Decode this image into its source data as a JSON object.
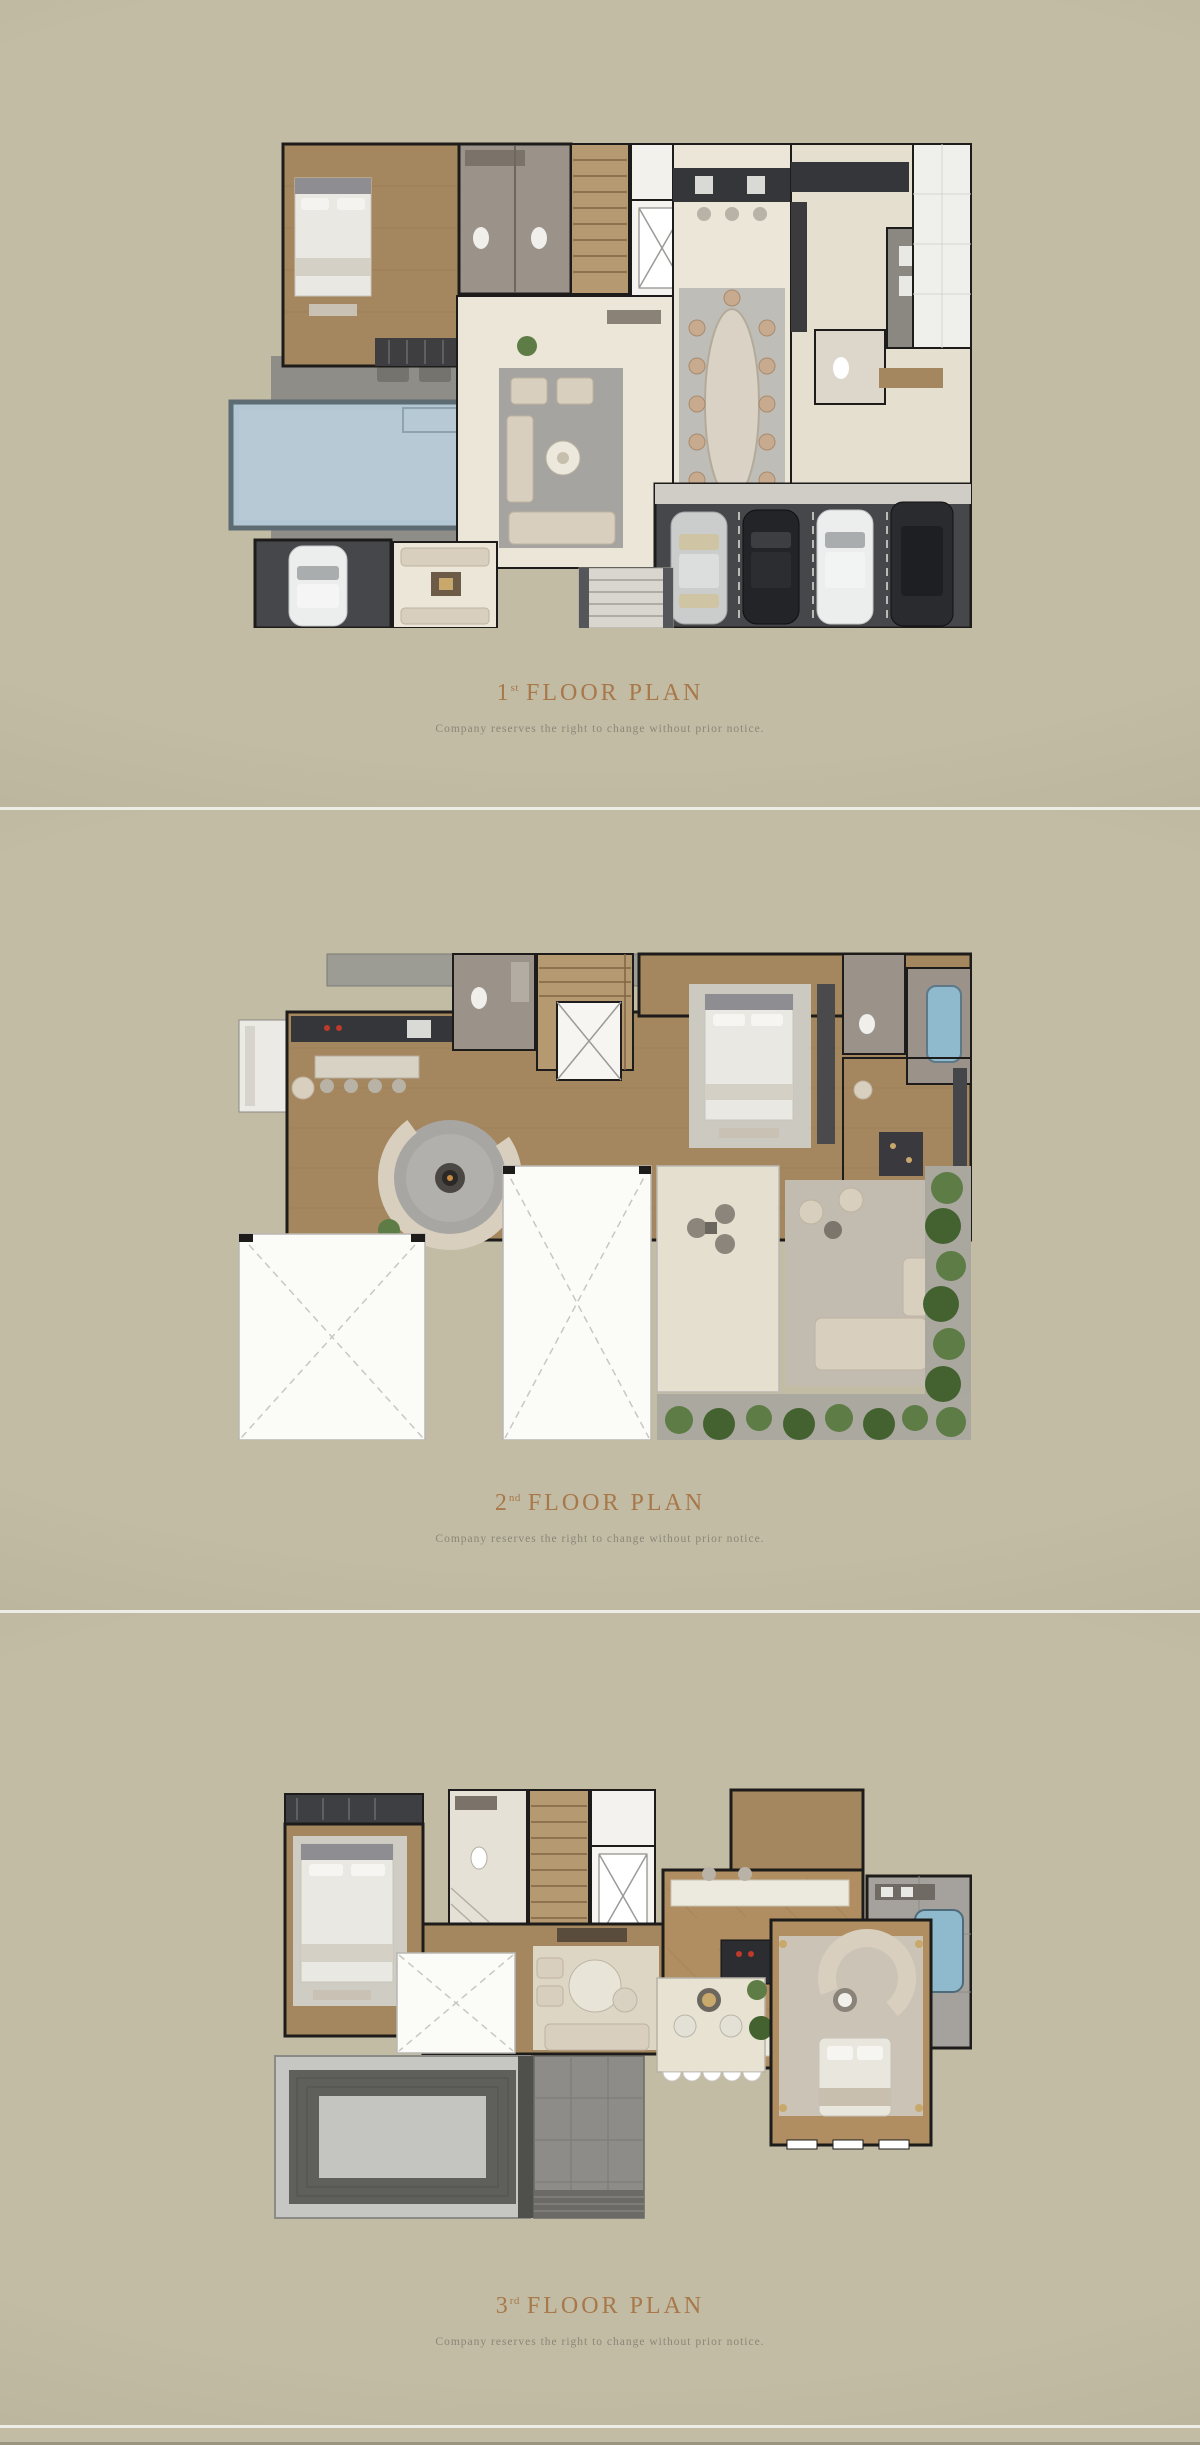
{
  "palette": {
    "background": "#c2bca4",
    "background_edge": "#b1ab95",
    "divider": "#edece6",
    "title_text": "#a8784a",
    "disclaimer_text": "#8b8678",
    "wall": "#1d1c1a",
    "wood_floor": "#a5875f",
    "wood_dark": "#7f6544",
    "stair_wood": "#b59a71",
    "cream_floor": "#ebe6d8",
    "cream_floor_2": "#e4dfcf",
    "rug_gray": "#a6a4a0",
    "rug_light": "#c7c4bc",
    "marble": "#9b938a",
    "deck_gray": "#8f8d87",
    "garage_dark": "#46474a",
    "apron": "#cfcdc5",
    "pool_blue": "#b2c7d3",
    "pool_edge": "#5d6b73",
    "tub_blue": "#8fb9cd",
    "void_white": "#fbfbf8",
    "dash_gray": "#c9c7c2",
    "plant_green": "#5e7c45",
    "plant_green_dark": "#44622f",
    "sofa_beige": "#d9cfbf",
    "counter_dark": "#35363a",
    "roof_light": "#c6c6c3",
    "roof_dark": "#5f5f5c",
    "white_tile": "#eff0ec",
    "car_white": "#eceeee",
    "car_silver": "#cbcdcd",
    "car_black": "#232427",
    "herringbone_wood": "#b08e62",
    "patio_gray": "#8e8c88"
  },
  "sections": [
    {
      "id": "floor-1",
      "title_number": "1",
      "title_ordinal": "st",
      "title_text": "FLOOR PLAN",
      "disclaimer": "Company reserves the right to change without prior notice."
    },
    {
      "id": "floor-2",
      "title_number": "2",
      "title_ordinal": "nd",
      "title_text": "FLOOR PLAN",
      "disclaimer": "Company reserves the right to change without prior notice."
    },
    {
      "id": "floor-3",
      "title_number": "3",
      "title_ordinal": "rd",
      "title_text": "FLOOR PLAN",
      "disclaimer": "Company reserves the right to change without prior notice."
    }
  ]
}
